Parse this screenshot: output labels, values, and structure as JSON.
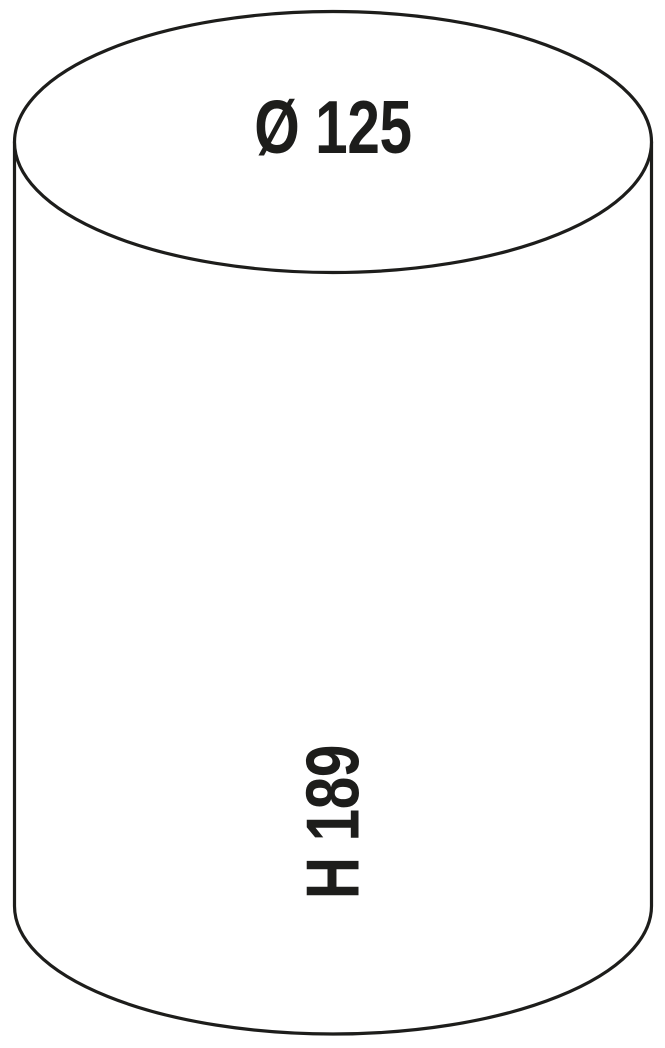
{
  "diagram": {
    "type": "cylinder-dimension-drawing",
    "diameter_label": "Ø 125",
    "height_label": "H 189",
    "stroke_color": "#1d1d1b",
    "fill_color": "#ffffff",
    "background_color": "#ffffff"
  }
}
